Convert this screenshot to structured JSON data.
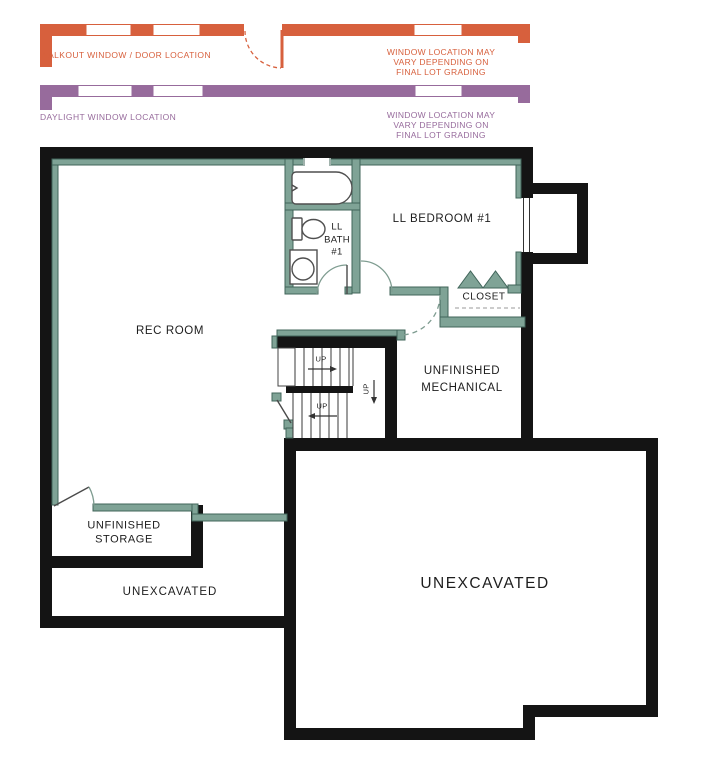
{
  "colors": {
    "walkout": "#d7603d",
    "daylight": "#976b9c",
    "wall": "#141414",
    "interior": "#7fa396",
    "interioredge": "#40655a",
    "arc": "#7e9c90",
    "text": "#1d1d1d"
  },
  "legend": {
    "walkout": {
      "label": "WALKOUT WINDOW / DOOR LOCATION",
      "note": [
        "WINDOW LOCATION MAY",
        "VARY DEPENDING ON",
        "FINAL LOT GRADING"
      ]
    },
    "daylight": {
      "label": "DAYLIGHT WINDOW LOCATION",
      "note": [
        "WINDOW LOCATION MAY",
        "VARY DEPENDING ON",
        "FINAL LOT GRADING"
      ]
    }
  },
  "rooms": {
    "rec_room": "REC ROOM",
    "bath": [
      "LL",
      "BATH",
      "#1"
    ],
    "bedroom": "LL BEDROOM #1",
    "closet": "CLOSET",
    "mechanical": [
      "UNFINISHED",
      "MECHANICAL"
    ],
    "storage": [
      "UNFINISHED",
      "STORAGE"
    ],
    "unexcavated_small": "UNEXCAVATED",
    "unexcavated_large": "UNEXCAVATED"
  },
  "stairs": {
    "up_upper": "UP",
    "up_lower": "UP",
    "up_landing": "UP"
  }
}
